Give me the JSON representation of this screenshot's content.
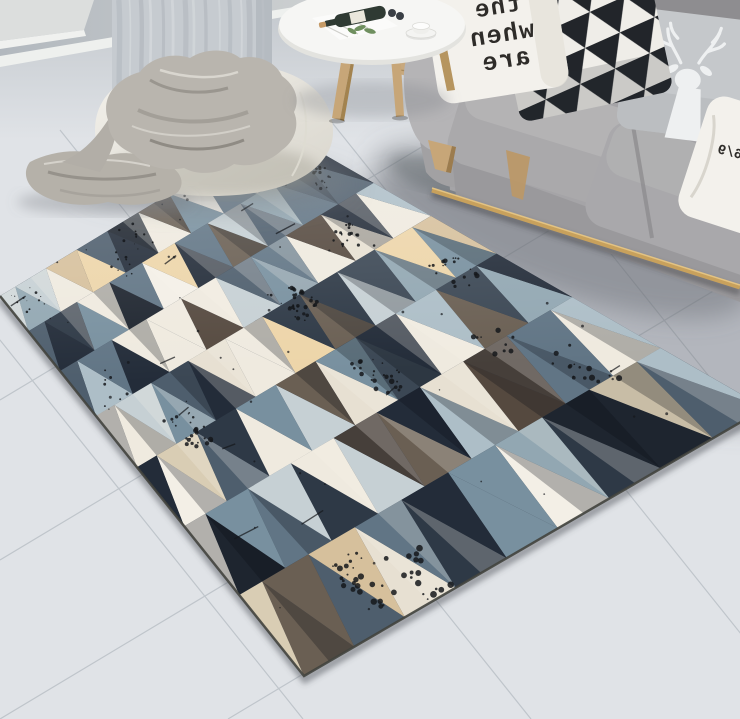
{
  "scene": {
    "subject": "Geometric triangle-pattern area rug",
    "setting": "Scandinavian living room with gray sofa, white pouf, sheer curtain and round side table"
  },
  "pillows": {
    "text_pillow": {
      "lines": [
        "the",
        "when",
        "are"
      ],
      "mirrored": true
    },
    "side_pillow": {
      "marks": "6/9",
      "mirrored": true
    },
    "triangle_pillow": {
      "pattern": "triangle-checker"
    },
    "deer_pillow": {
      "motif": "deer-silhouette"
    }
  },
  "rug": {
    "rows": 7,
    "cols": 9,
    "seed": 11,
    "speckle_clusters": 16,
    "base": "#2e3744",
    "edge": "#43443e",
    "speckle": "#15171b",
    "palette": [
      [
        "#232c39",
        3
      ],
      [
        "#2e3946",
        2
      ],
      [
        "#3b4754",
        2
      ],
      [
        "#1e252f",
        1
      ],
      [
        "#4e5e6d",
        2
      ],
      [
        "#617585",
        2
      ],
      [
        "#78909f",
        2
      ],
      [
        "#92a7b2",
        1
      ],
      [
        "#adbec7",
        1
      ],
      [
        "#c6d0d4",
        1
      ],
      [
        "#efeadf",
        2
      ],
      [
        "#e7e0d2",
        1
      ],
      [
        "#f3efe6",
        1
      ],
      [
        "#d9cdb4",
        1
      ],
      [
        "#d6c09c",
        1
      ],
      [
        "#edd5a9",
        1
      ],
      [
        "#c8bda6",
        1
      ],
      [
        "#463f3a",
        1
      ],
      [
        "#55493f",
        1
      ],
      [
        "#6a5f53",
        1
      ]
    ]
  },
  "colors": {
    "floor": "#e0e3e7",
    "wall": "#b7bdc3",
    "baseboard": "#eef0ee",
    "wall_panel": "#dcdedd",
    "curtain": "#c6cbd0",
    "sofa_body": "#aaa9ab",
    "sofa_light": "#b5b4b6",
    "sofa_dark": "#8e8d90",
    "sofa_front": "#9a999c",
    "rail": "#c8a15c",
    "wood": "#c7a678",
    "pouf": "#f0eee8",
    "blanket": "#b9b5ae",
    "blanket_trail": "#b5b1a9",
    "table": "#f6f6f4",
    "pillow_white": "#f3f1ec",
    "ink": "#2e2c29",
    "tri_dark": "#22252a",
    "tri_light": "#efede8",
    "deer_bg": "#c5c8cb",
    "deer_fg": "#eef0f1",
    "bottle": "#2f3a33",
    "plant": "#6f8f5f",
    "basket": "#c8a97e",
    "stool": "#cbaa80"
  }
}
